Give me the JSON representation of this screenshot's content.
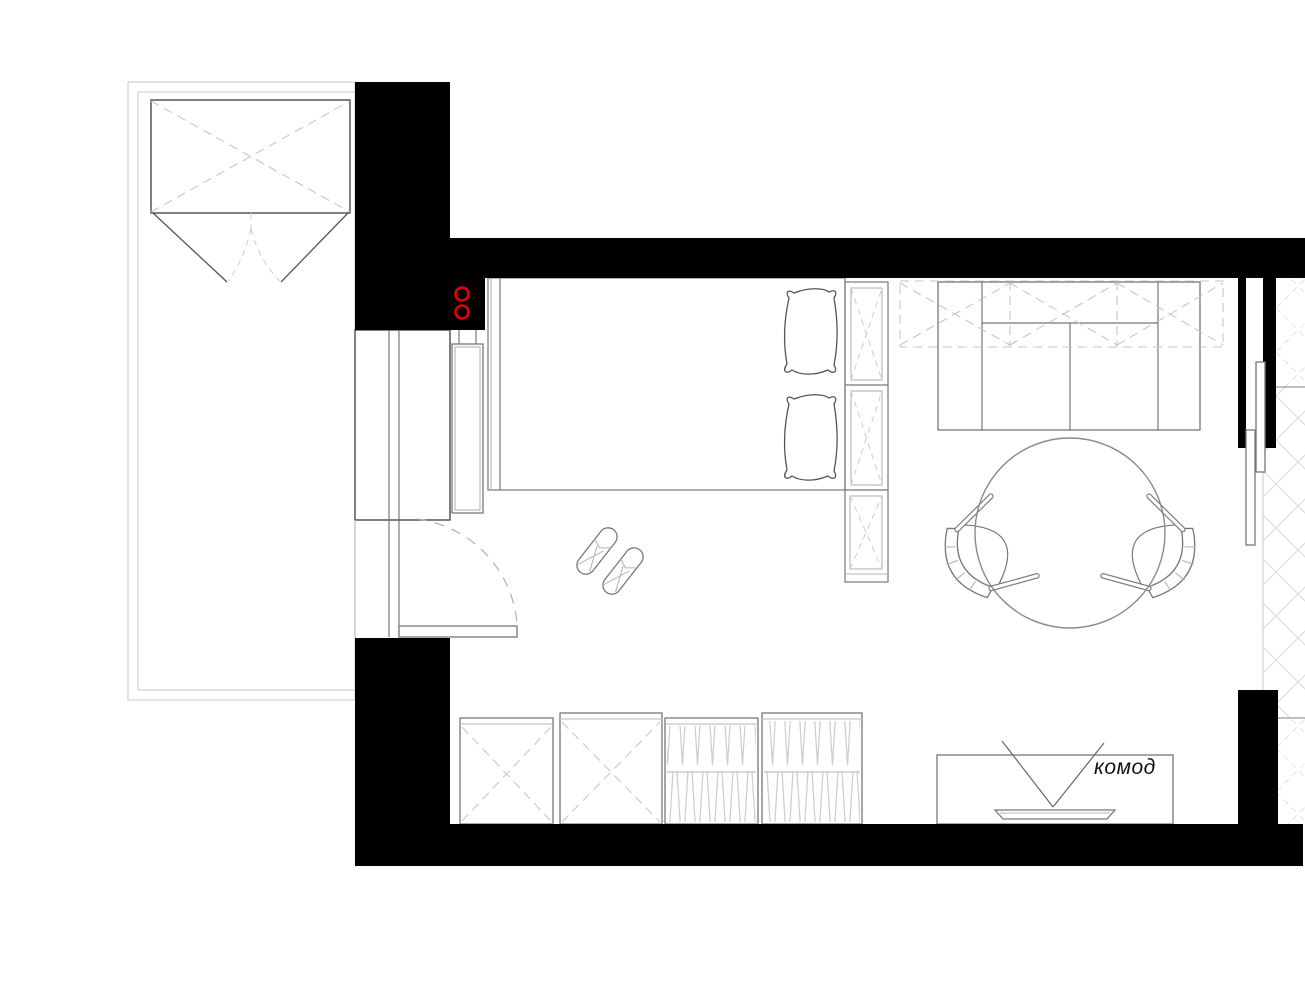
{
  "document": {
    "type": "apartment bedroom floor plan (fragment)",
    "language": "ru"
  },
  "labels": {
    "dresser": "комод"
  },
  "colors": {
    "walls": "#000000",
    "outlet_accent": "#e60000",
    "furniture_lines": "#777777",
    "dashed_lines": "#c6c6c6",
    "background": "#ffffff"
  },
  "icons": [
    {
      "name": "power-outlet-icon",
      "count": 2,
      "color": "#e60000"
    }
  ],
  "furniture": [
    "balcony",
    "balcony-wardrobe",
    "entry-door-swing",
    "built-in-closet",
    "radiator",
    "double-bed",
    "pillow-top",
    "pillow-bottom",
    "bedside-shelving-3-cells",
    "slippers-pair",
    "sofa",
    "overhead-wall-cabinets-dashed",
    "round-dining-table",
    "chair-left",
    "chair-right",
    "sliding-door-two-panels",
    "adjacent-closet-hatched",
    "base-cabinet-1",
    "base-cabinet-2",
    "wardrobe-cabinet-3",
    "wardrobe-cabinet-4",
    "dresser-with-tv"
  ]
}
